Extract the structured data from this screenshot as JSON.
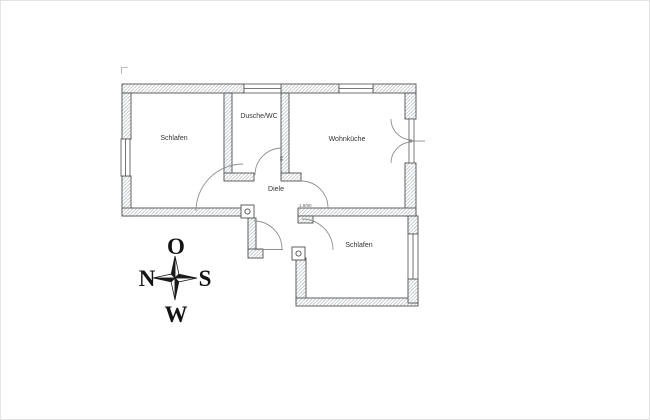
{
  "floor_plan": {
    "rooms": [
      {
        "id": "bedroom-1",
        "label": "Schlafen"
      },
      {
        "id": "shower-wc",
        "label": "Dusche/WC"
      },
      {
        "id": "living-kitchen",
        "label": "Wohnküche"
      },
      {
        "id": "hallway",
        "label": "Diele"
      },
      {
        "id": "bedroom-2",
        "label": "Schlafen"
      }
    ],
    "dimension_labels": [
      {
        "id": "door-dim-horizontal",
        "label": "1.9/90"
      },
      {
        "id": "door-dim-vertical",
        "label": "90"
      }
    ]
  },
  "compass": {
    "top": "O",
    "left": "N",
    "right": "S",
    "bottom": "W"
  },
  "colors": {
    "background": "#ffffff",
    "wall_outline": "#4f4f4f",
    "wall_hatch": "#b3b9bd",
    "door_arc": "#8f8f8f",
    "room_label": "#333333",
    "dimension_text": "#666666",
    "compass": "#1a1a1a"
  }
}
